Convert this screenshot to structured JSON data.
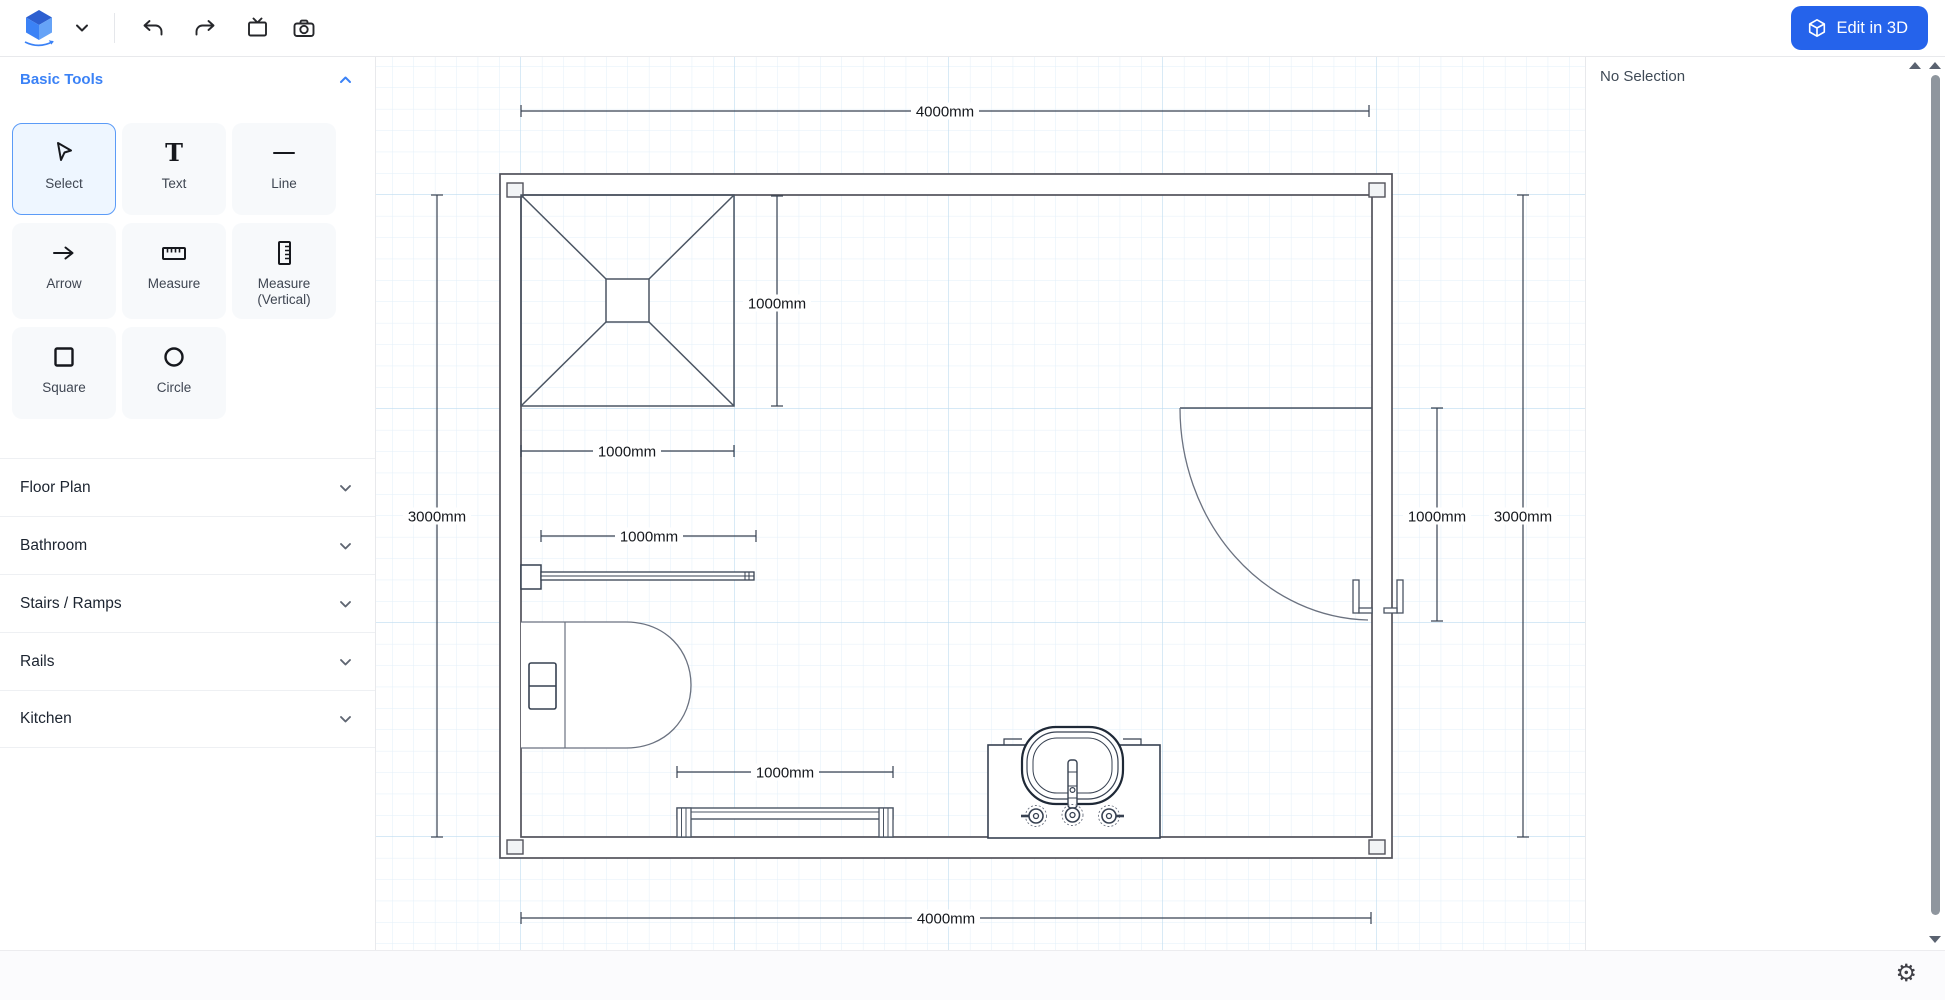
{
  "toolbar": {
    "edit_3d_label": "Edit in 3D",
    "icons": [
      "app-logo-cube",
      "chevron-down",
      "undo",
      "redo",
      "display",
      "camera"
    ]
  },
  "sidebar": {
    "basic_tools_header": "Basic Tools",
    "tools": [
      {
        "label": "Select",
        "selected": true
      },
      {
        "label": "Text",
        "selected": false
      },
      {
        "label": "Line",
        "selected": false
      },
      {
        "label": "Arrow",
        "selected": false
      },
      {
        "label": "Measure",
        "selected": false
      },
      {
        "label": "Measure (Vertical)",
        "selected": false
      },
      {
        "label": "Square",
        "selected": false
      },
      {
        "label": "Circle",
        "selected": false
      }
    ],
    "sections": [
      "Floor Plan",
      "Bathroom",
      "Stairs / Ramps",
      "Rails",
      "Kitchen"
    ]
  },
  "inspector": {
    "empty_label": "No Selection"
  },
  "canvas": {
    "dims": {
      "top": "4000mm",
      "bottom": "4000mm",
      "left": "3000mm",
      "right": "3000mm",
      "door": "1000mm",
      "shower_h": "1000mm",
      "shower_w": "1000mm",
      "rail": "1000mm",
      "bench": "1000mm"
    },
    "objects": [
      "room-walls",
      "shower",
      "toilet",
      "sink",
      "door",
      "grab-rail",
      "bench-rail"
    ]
  },
  "statusbar": {
    "gear_glyph": "⚙"
  },
  "colors": {
    "accent": "#2563eb",
    "tool_header": "#3b82f6",
    "grid_minor": "#e2eff9",
    "grid_major": "#bedcf0",
    "wall_stroke": "#52525b"
  }
}
